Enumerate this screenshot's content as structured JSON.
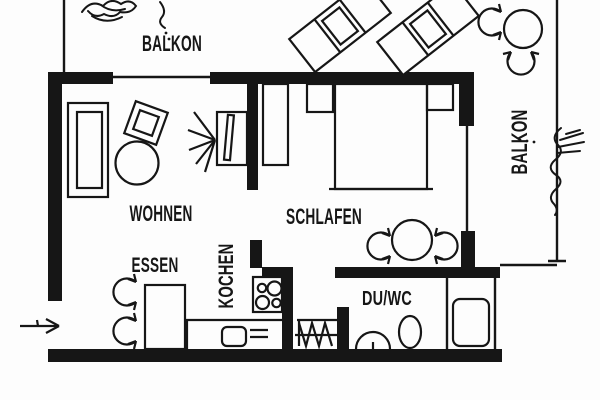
{
  "document": {
    "type": "apartment floor plan",
    "style": "black ink on white, scanned architectural drawing"
  },
  "colors": {
    "ink": "#161616",
    "paper": "#fdfdfd"
  },
  "labels": {
    "balkon_top": "BALKON",
    "balkon_right": "BALKON",
    "wohnen": "WOHNEN",
    "schlafen": "SCHLAFEN",
    "essen": "ESSEN",
    "kochen": "KOCHEN",
    "duwc": "DU/WC"
  },
  "rooms": [
    {
      "name": "BALKON",
      "position": "top",
      "furniture": [
        "plant",
        "sun-lounger",
        "sun-lounger",
        "round-table",
        "chair",
        "chair"
      ]
    },
    {
      "name": "BALKON",
      "position": "right",
      "furniture": [
        "plant"
      ]
    },
    {
      "name": "WOHNEN",
      "furniture": [
        "sofa",
        "armchair",
        "coffee-table",
        "tv"
      ]
    },
    {
      "name": "SCHLAFEN",
      "furniture": [
        "wardrobe",
        "nightstand",
        "double-bed",
        "nightstand",
        "round-table",
        "chair",
        "chair"
      ]
    },
    {
      "name": "ESSEN",
      "furniture": [
        "dining-table",
        "chair",
        "chair"
      ]
    },
    {
      "name": "KOCHEN",
      "furniture": [
        "stove",
        "counter",
        "sink",
        "drainer"
      ]
    },
    {
      "name": "DU/WC",
      "furniture": [
        "washbasin",
        "toilet",
        "shower"
      ]
    }
  ],
  "icons": {
    "entrance": "entry-arrow pointing right through wall opening, bottom left",
    "radiator": "zigzag radiator symbol in niche between KOCHEN and DU/WC",
    "chairs": "curved open arcs with arrowheads",
    "windows": "thin single lines in thick exterior walls"
  }
}
